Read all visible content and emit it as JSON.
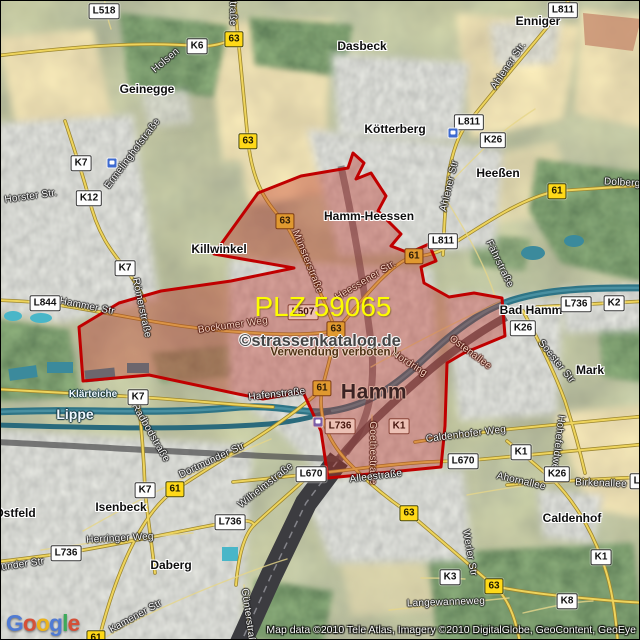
{
  "map": {
    "plz_label": "PLZ 59065",
    "watermark": {
      "line1": "©strassenkatalog.de",
      "line2": "Verwendung verboten !"
    },
    "city_label": {
      "text": "Hamm",
      "x": 373,
      "y": 391
    },
    "attribution": "Map data ©2010 Tele Atlas, Imagery ©2010 DigitalGlobe, GeoContent, GeoEye",
    "logo": {
      "text": "Google",
      "letter_colors": [
        "#4a77d4",
        "#d6492f",
        "#eeb211",
        "#4a77d4",
        "#35a854",
        "#d6492f"
      ]
    },
    "colors": {
      "boundary": "#c00000",
      "boundary_fill": "rgba(190,45,35,0.38)",
      "road_badge_yellow": "#ffd918",
      "road_badge_white": "#fdfdfd",
      "water": "#2e7486",
      "plz_text": "#fdfd00"
    },
    "boundary_points": [
      [
        352,
        152
      ],
      [
        363,
        162
      ],
      [
        355,
        178
      ],
      [
        370,
        172
      ],
      [
        385,
        195
      ],
      [
        377,
        210
      ],
      [
        400,
        233
      ],
      [
        390,
        245
      ],
      [
        408,
        252
      ],
      [
        428,
        243
      ],
      [
        435,
        260
      ],
      [
        420,
        266
      ],
      [
        423,
        282
      ],
      [
        448,
        296
      ],
      [
        473,
        292
      ],
      [
        501,
        297
      ],
      [
        504,
        335
      ],
      [
        463,
        352
      ],
      [
        446,
        362
      ],
      [
        444,
        425
      ],
      [
        440,
        466
      ],
      [
        327,
        477
      ],
      [
        320,
        430
      ],
      [
        302,
        391
      ],
      [
        262,
        398
      ],
      [
        237,
        393
      ],
      [
        148,
        374
      ],
      [
        82,
        380
      ],
      [
        78,
        326
      ],
      [
        118,
        302
      ],
      [
        160,
        290
      ],
      [
        230,
        280
      ],
      [
        293,
        267
      ],
      [
        213,
        253
      ],
      [
        257,
        192
      ],
      [
        300,
        175
      ],
      [
        347,
        167
      ]
    ],
    "road_badges": [
      {
        "text": "L518",
        "x": 103,
        "y": 10,
        "style": "white"
      },
      {
        "text": "63",
        "x": 233,
        "y": 38,
        "style": "yellow"
      },
      {
        "text": "K6",
        "x": 196,
        "y": 45,
        "style": "white"
      },
      {
        "text": "L811",
        "x": 562,
        "y": 9,
        "style": "white"
      },
      {
        "text": "63",
        "x": 247,
        "y": 140,
        "style": "yellow"
      },
      {
        "text": "L811",
        "x": 468,
        "y": 121,
        "style": "white"
      },
      {
        "text": "K26",
        "x": 492,
        "y": 139,
        "style": "white"
      },
      {
        "text": "K7",
        "x": 80,
        "y": 162,
        "style": "white"
      },
      {
        "text": "61",
        "x": 556,
        "y": 190,
        "style": "yellow"
      },
      {
        "text": "K12",
        "x": 88,
        "y": 197,
        "style": "white"
      },
      {
        "text": "63",
        "x": 284,
        "y": 220,
        "style": "tinted-yellow"
      },
      {
        "text": "L811",
        "x": 442,
        "y": 240,
        "style": "white"
      },
      {
        "text": "61",
        "x": 413,
        "y": 255,
        "style": "tinted-yellow"
      },
      {
        "text": "K7",
        "x": 124,
        "y": 267,
        "style": "white"
      },
      {
        "text": "L844",
        "x": 44,
        "y": 302,
        "style": "white"
      },
      {
        "text": "L736",
        "x": 575,
        "y": 303,
        "style": "white"
      },
      {
        "text": "K2",
        "x": 613,
        "y": 302,
        "style": "white"
      },
      {
        "text": "L507",
        "x": 302,
        "y": 311,
        "style": "tinted-white"
      },
      {
        "text": "K26",
        "x": 522,
        "y": 327,
        "style": "white"
      },
      {
        "text": "63",
        "x": 335,
        "y": 328,
        "style": "tinted-yellow"
      },
      {
        "text": "61",
        "x": 321,
        "y": 387,
        "style": "tinted-yellow"
      },
      {
        "text": "K7",
        "x": 137,
        "y": 396,
        "style": "white"
      },
      {
        "text": "L736",
        "x": 339,
        "y": 425,
        "style": "tinted-white"
      },
      {
        "text": "K1",
        "x": 398,
        "y": 425,
        "style": "tinted-white"
      },
      {
        "text": "K1",
        "x": 520,
        "y": 451,
        "style": "white"
      },
      {
        "text": "L670",
        "x": 462,
        "y": 460,
        "style": "white"
      },
      {
        "text": "K26",
        "x": 556,
        "y": 473,
        "style": "white"
      },
      {
        "text": "L670",
        "x": 310,
        "y": 473,
        "style": "white"
      },
      {
        "text": "L736",
        "x": 644,
        "y": 480,
        "style": "white"
      },
      {
        "text": "61",
        "x": 174,
        "y": 488,
        "style": "yellow"
      },
      {
        "text": "K7",
        "x": 144,
        "y": 489,
        "style": "white"
      },
      {
        "text": "63",
        "x": 408,
        "y": 512,
        "style": "yellow"
      },
      {
        "text": "L736",
        "x": 229,
        "y": 521,
        "style": "white"
      },
      {
        "text": "L736",
        "x": 65,
        "y": 552,
        "style": "white"
      },
      {
        "text": "K1",
        "x": 600,
        "y": 556,
        "style": "white"
      },
      {
        "text": "K3",
        "x": 449,
        "y": 576,
        "style": "white"
      },
      {
        "text": "63",
        "x": 493,
        "y": 585,
        "style": "yellow"
      },
      {
        "text": "K8",
        "x": 566,
        "y": 600,
        "style": "white"
      },
      {
        "text": "61",
        "x": 95,
        "y": 637,
        "style": "yellow"
      }
    ],
    "place_labels": [
      {
        "text": "Enniger",
        "x": 537,
        "y": 20
      },
      {
        "text": "Dasbeck",
        "x": 361,
        "y": 45
      },
      {
        "text": "Geinegge",
        "x": 146,
        "y": 88
      },
      {
        "text": "Kötterberg",
        "x": 394,
        "y": 128
      },
      {
        "text": "Heeßen",
        "x": 497,
        "y": 172
      },
      {
        "text": "Hamm-Heessen",
        "x": 368,
        "y": 215
      },
      {
        "text": "Killwinkel",
        "x": 218,
        "y": 248
      },
      {
        "text": "Bad Hamm",
        "x": 530,
        "y": 309
      },
      {
        "text": "Mark",
        "x": 589,
        "y": 369
      },
      {
        "text": "Isenbeck",
        "x": 120,
        "y": 506
      },
      {
        "text": "Ostfeld",
        "x": 14,
        "y": 512
      },
      {
        "text": "Daberg",
        "x": 170,
        "y": 564
      },
      {
        "text": "Caldenhof",
        "x": 571,
        "y": 517
      }
    ],
    "street_labels": [
      {
        "text": "straße",
        "x": 231,
        "y": 10,
        "rot": 90
      },
      {
        "text": "Holsen",
        "x": 165,
        "y": 60,
        "rot": -40
      },
      {
        "text": "Ahlener Str.",
        "x": 508,
        "y": 65,
        "rot": -56
      },
      {
        "text": "Ermelinghofstraße",
        "x": 132,
        "y": 153,
        "rot": -53
      },
      {
        "text": "Ahlener Str",
        "x": 449,
        "y": 185,
        "rot": -77
      },
      {
        "text": "Dolberger Str",
        "x": 634,
        "y": 183,
        "rot": 3
      },
      {
        "text": "Horster Str.",
        "x": 30,
        "y": 196,
        "rot": -8
      },
      {
        "text": "Münsterstraße",
        "x": 306,
        "y": 261,
        "rot": 68,
        "tinted": true
      },
      {
        "text": "Fährstraße",
        "x": 498,
        "y": 263,
        "rot": 64
      },
      {
        "text": "Heessener Str.",
        "x": 365,
        "y": 280,
        "rot": -31,
        "tinted": true
      },
      {
        "text": "Hammer Str",
        "x": 86,
        "y": 306,
        "rot": 11
      },
      {
        "text": "Römerstraße",
        "x": 140,
        "y": 307,
        "rot": 78
      },
      {
        "text": "Bockumer Weg",
        "x": 232,
        "y": 325,
        "rot": -8,
        "tinted": true
      },
      {
        "text": "Ostenallee",
        "x": 469,
        "y": 352,
        "rot": 37,
        "tinted": true
      },
      {
        "text": "Soester Str",
        "x": 555,
        "y": 361,
        "rot": 51
      },
      {
        "text": "Nordring",
        "x": 408,
        "y": 363,
        "rot": 33,
        "tinted": true
      },
      {
        "text": "Hafenstraße",
        "x": 276,
        "y": 394,
        "rot": -6
      },
      {
        "text": "Radbodstraße",
        "x": 149,
        "y": 432,
        "rot": 60
      },
      {
        "text": "Caldenhofer Weg",
        "x": 465,
        "y": 434,
        "rot": -7
      },
      {
        "text": "Hohefeldweg",
        "x": 556,
        "y": 444,
        "rot": 97
      },
      {
        "text": "Goethestraße",
        "x": 371,
        "y": 452,
        "rot": 90,
        "tinted": true
      },
      {
        "text": "Dortmunder Str",
        "x": 211,
        "y": 460,
        "rot": -25
      },
      {
        "text": "Alleestraße",
        "x": 375,
        "y": 476,
        "rot": -7
      },
      {
        "text": "Ahornallee",
        "x": 520,
        "y": 481,
        "rot": 13
      },
      {
        "text": "Birkenallee",
        "x": 600,
        "y": 483,
        "rot": 2
      },
      {
        "text": "Wilhelmstraße",
        "x": 265,
        "y": 485,
        "rot": -38
      },
      {
        "text": "Herringer Weg",
        "x": 119,
        "y": 538,
        "rot": -3
      },
      {
        "text": "Werler Str",
        "x": 468,
        "y": 552,
        "rot": 80
      },
      {
        "text": "Dortmunder Str",
        "x": 8,
        "y": 566,
        "rot": -8
      },
      {
        "text": "Langewanneweg",
        "x": 445,
        "y": 602,
        "rot": -2
      },
      {
        "text": "Kamener Str",
        "x": 135,
        "y": 616,
        "rot": -29
      },
      {
        "text": "Günterstraße",
        "x": 247,
        "y": 618,
        "rot": 82
      }
    ],
    "water_labels": [
      {
        "text": "Klärteiche",
        "x": 92,
        "y": 394,
        "size": 10
      },
      {
        "text": "Lippe",
        "x": 74,
        "y": 413,
        "size": 14
      }
    ],
    "transit_icons": [
      {
        "x": 452,
        "y": 132
      },
      {
        "x": 111,
        "y": 162
      },
      {
        "x": 317,
        "y": 421,
        "tinted": true
      }
    ]
  }
}
